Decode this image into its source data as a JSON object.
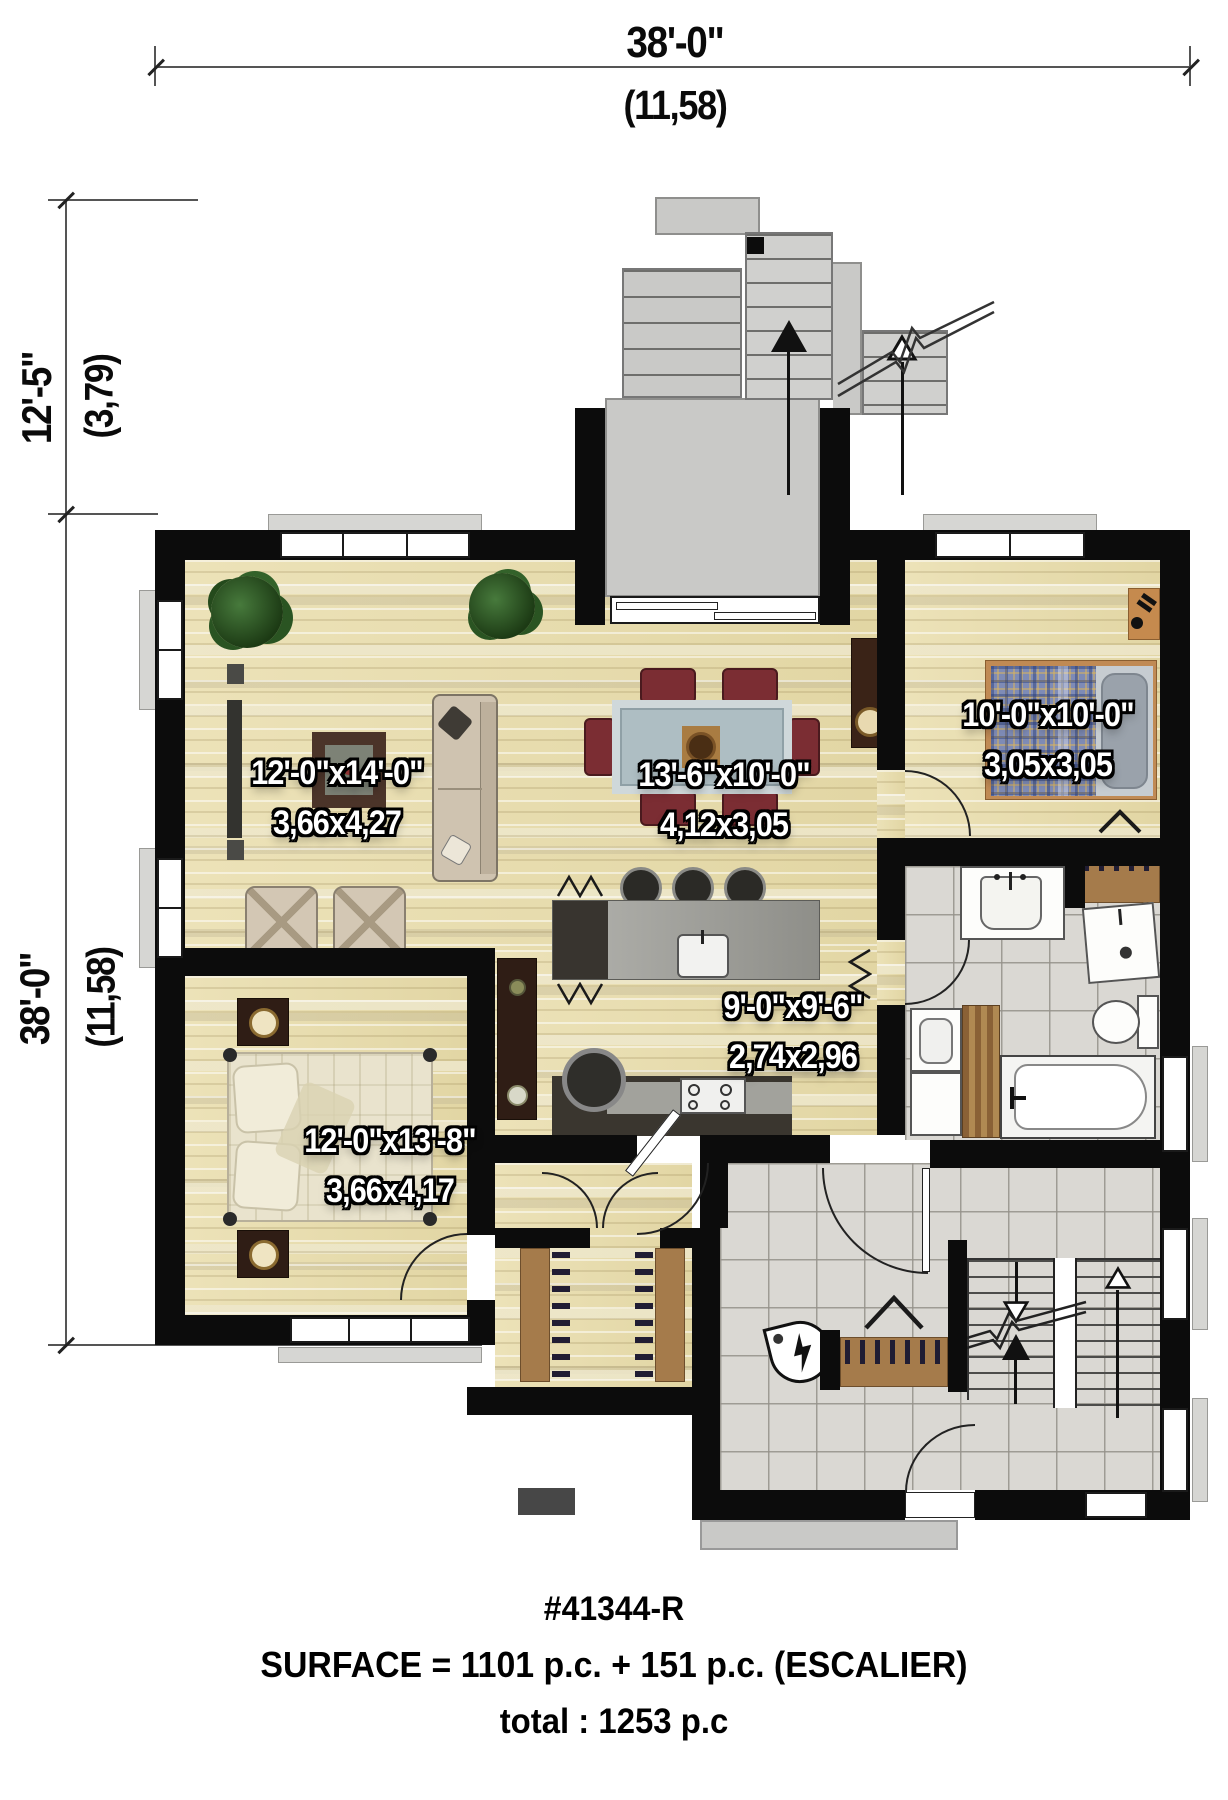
{
  "dimensions": {
    "top": {
      "imperial": "38'-0\"",
      "metric": "(11,58)"
    },
    "left_upper": {
      "imperial": "12'-5\"",
      "metric": "(3,79)"
    },
    "left_lower": {
      "imperial": "38'-0\"",
      "metric": "(11,58)"
    }
  },
  "rooms": {
    "living": {
      "imperial": "12'-0\"x14'-0\"",
      "metric": "3,66x4,27"
    },
    "dining": {
      "imperial": "13'-6\"x10'-0\"",
      "metric": "4,12x3,05"
    },
    "bedroom": {
      "imperial": "10'-0\"x10'-0\"",
      "metric": "3,05x3,05"
    },
    "kitchen": {
      "imperial": "9'-0\"x9'-6\"",
      "metric": "2,74x2,96"
    },
    "master_bedroom": {
      "imperial": "12'-0\"x13'-8\"",
      "metric": "3,66x4,17"
    }
  },
  "footer": {
    "plan_number": "#41344-R",
    "surface_line": "SURFACE = 1101 p.c. + 151 p.c. (ESCALIER)",
    "total_line": "total : 1253 p.c"
  },
  "icons": {
    "stair_up_solid": "solid up arrow",
    "stair_up_open": "open up arrow",
    "stair_down_open": "open down arrow",
    "doorbell_chime": "lightning bolt in teardrop",
    "closet_rod": "row of hangers",
    "bifold_door": "chevron"
  },
  "colors": {
    "wall": "#0c0c0c",
    "hardwood": "#e8deb0",
    "tile": "#dad8d3",
    "deck": "#c9c9c7",
    "room_label_text": "#ffffff",
    "room_label_outline": "#000000",
    "dining_chair": "#7b2d33",
    "bed_plaid": "#7e8bb6",
    "dark_furniture": "#2f1d15",
    "closet_wood": "#a57b4b",
    "granite": "#a2a29c",
    "dimension_text": "#0a0a0a"
  }
}
